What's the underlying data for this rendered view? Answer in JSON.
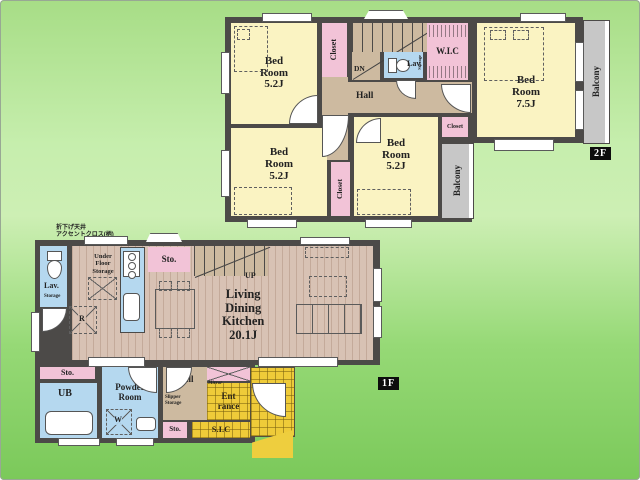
{
  "colors": {
    "wall": "#4c4a48",
    "room_yellow": "#faf3c2",
    "closet_pink": "#f2c3d7",
    "wet_area_blue": "#b5d8ef",
    "hall_tan": "#cdbaa0",
    "wood_floor": "#d8c2b4",
    "balcony_gray": "#c7c7c7",
    "entrance_tile_yellow": "#efcb39",
    "background_green": "#8fd56e"
  },
  "floor2": {
    "label": "2F",
    "bedroom_nw": "Bed\nRoom\n5.2J",
    "bedroom_e": "Bed\nRoom\n7.5J",
    "bedroom_sw": "Bed\nRoom\n5.2J",
    "bedroom_s": "Bed\nRoom\n5.2J",
    "closet_nw": "Closet",
    "closet_sw": "Closet",
    "closet_e": "Closet",
    "wic": "W.I.C",
    "lav": "Lav.",
    "lav_storage": "Storage",
    "hall": "Hall",
    "stairs": "DN",
    "balcony_e": "Balcony",
    "balcony_s": "Balcony"
  },
  "floor1": {
    "label": "1F",
    "annotation": "折下げ天井\nアクセントクロス(柄)",
    "ldk": "Living\nDining\nKitchen\n20.1J",
    "stairs": "UP",
    "under_floor_storage": "Under\nFloor\nStorage",
    "refrigerator": "R",
    "sto_kitchen": "Sto.",
    "lav": "Lav.",
    "lav_storage": "Storage",
    "sto_west": "Sto.",
    "ub": "UB",
    "powder_room": "Powder\nRoom",
    "washer": "W",
    "hall": "Hall",
    "slipper_storage": "Slipper\nStorage",
    "sto_hall": "Sto.",
    "mirror": "Mirror",
    "entrance": "Ent\nrance",
    "sic": "S.I.C"
  }
}
